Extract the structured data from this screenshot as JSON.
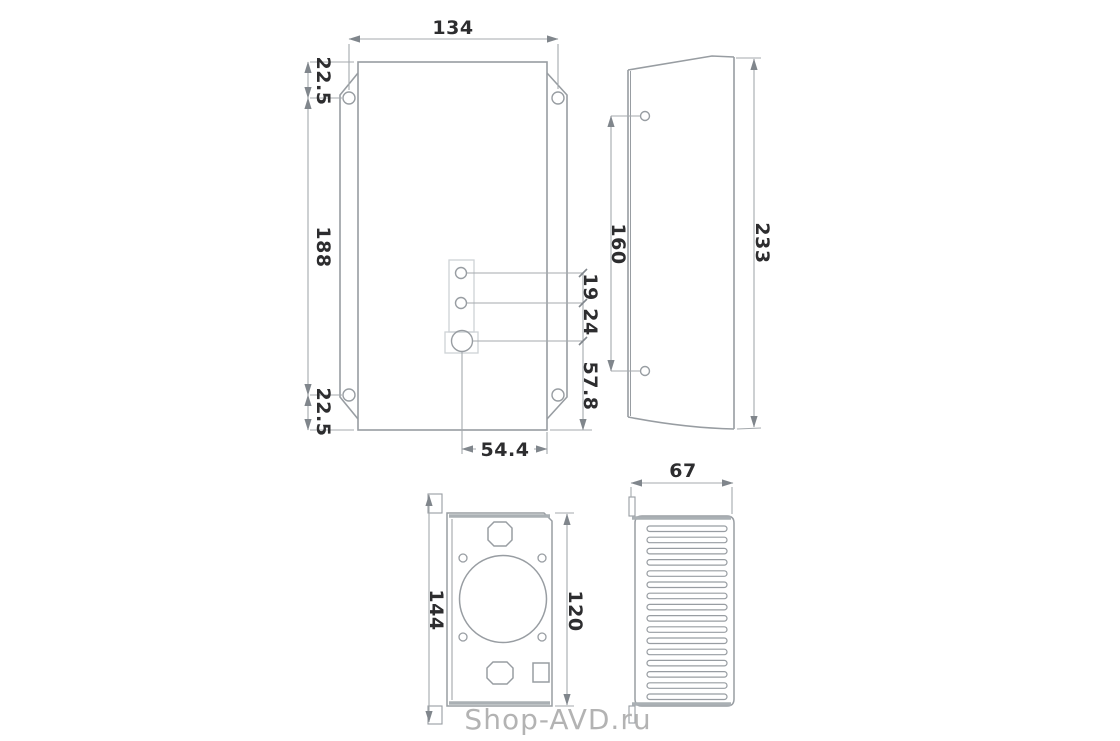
{
  "watermark": {
    "text": "Shop-AVD.ru"
  },
  "views": {
    "front": {
      "dims": {
        "width": "134",
        "flange_top": "22.5",
        "hole_span": "188",
        "flange_bottom": "22.5",
        "gap_19": "19",
        "gap_24": "24",
        "bottom_offset": "57.8",
        "horizontal": "54.4"
      }
    },
    "side": {
      "dims": {
        "hole_span": "160",
        "height": "233"
      }
    },
    "bottom": {
      "dims": {
        "overall": "144",
        "inner": "120"
      }
    },
    "back": {
      "dims": {
        "width": "67"
      }
    }
  },
  "colors": {
    "line": "#9aa0a5",
    "thick_edge": "#aab0b4",
    "detail": "#ced2d6",
    "dim_line": "#a4a9ad",
    "arrow": "#80868c",
    "dim_text": "#2d2d2f",
    "watermark": "#b3b3b3"
  }
}
